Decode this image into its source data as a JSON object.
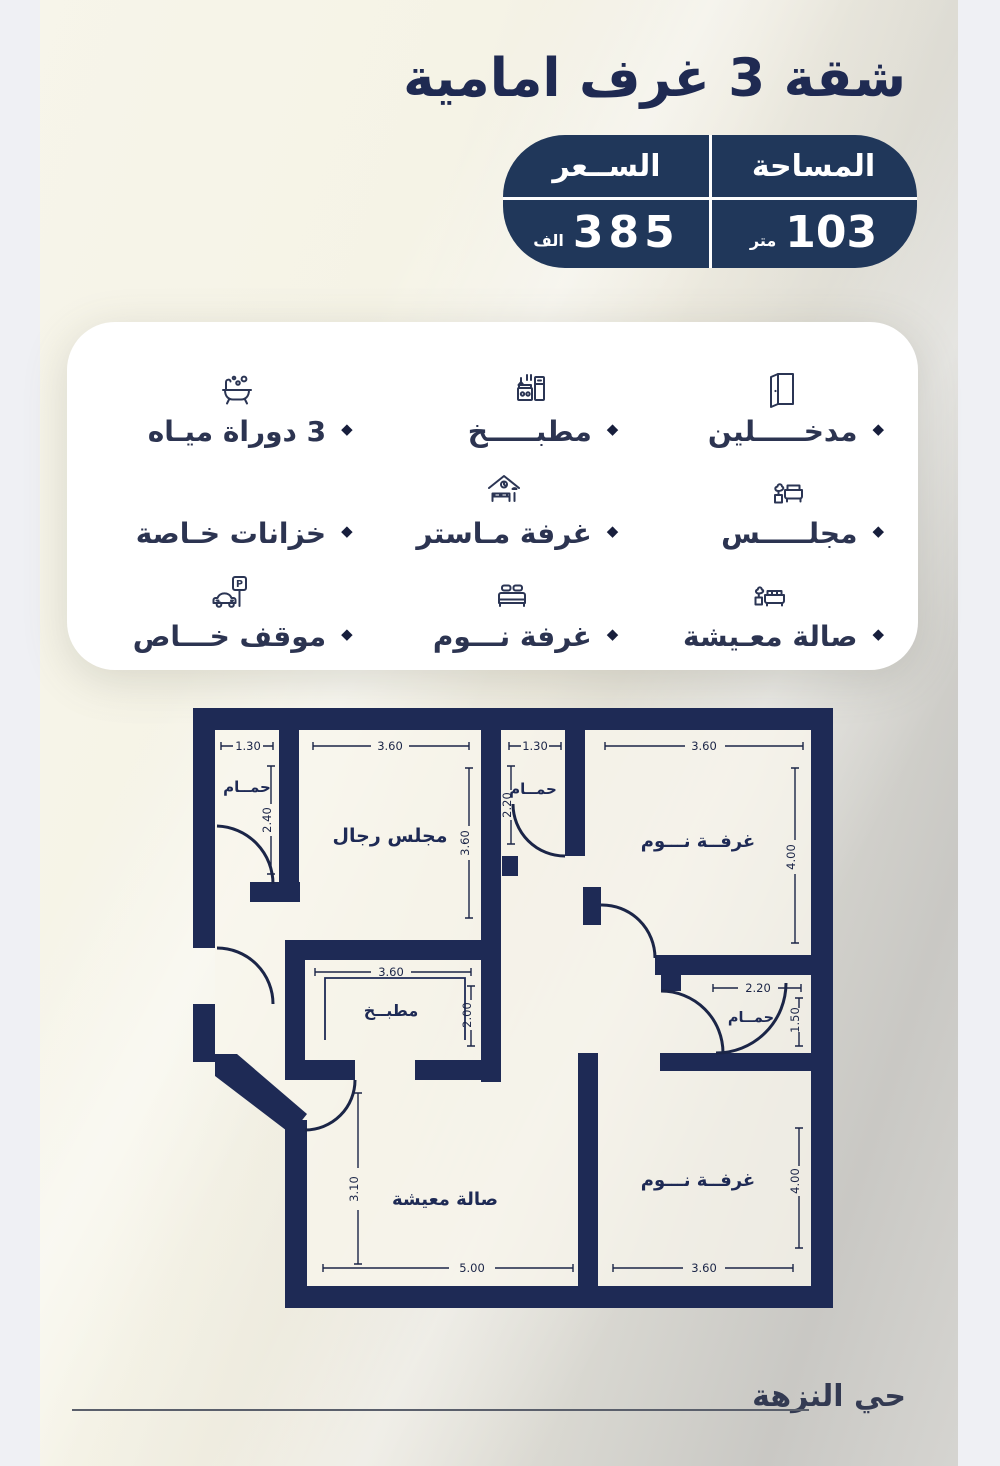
{
  "page": {
    "title": "شقة 3 غرف امامية"
  },
  "info_box": {
    "area": {
      "label": "المساحة",
      "value": "103",
      "unit": "متر"
    },
    "price": {
      "label": "الســعر",
      "value": "385",
      "unit": "الف"
    }
  },
  "features": {
    "bullet": "◆",
    "parking_letter": "P",
    "items": [
      {
        "label": "مدخـــــلين",
        "icon": "door-icon"
      },
      {
        "label": "مطبـــــخ",
        "icon": "kitchen-icon"
      },
      {
        "label": "3 دوراة ميـاه",
        "icon": "bathtub-icon"
      },
      {
        "label": "مجلـــــس",
        "icon": "majlis-sofa-icon"
      },
      {
        "label": "غرفة مـاستر",
        "icon": "master-bedroom-icon"
      },
      {
        "label": "خزانات خـاصة",
        "icon": "none"
      },
      {
        "label": "صالة معـيشة",
        "icon": "living-sofa-icon"
      },
      {
        "label": "غرفة نـــوم",
        "icon": "bed-icon"
      },
      {
        "label": "موقف خـــاص",
        "icon": "parking-icon"
      }
    ]
  },
  "floor_plan": {
    "rooms": {
      "bath_top_left": {
        "label": "حمــام",
        "width": "1.30",
        "height": "2.40"
      },
      "majlis": {
        "label": "مجلس رجال",
        "width": "3.60",
        "height": "3.60"
      },
      "bath_top_mid": {
        "label": "حمــام",
        "width": "1.30",
        "height": "2.20"
      },
      "bedroom_top": {
        "label": "غرفــة نـــوم",
        "width": "3.60",
        "height": "4.00"
      },
      "kitchen": {
        "label": "مطبــخ",
        "width": "3.60",
        "height": "2.00"
      },
      "bath_right": {
        "label": "حمــام",
        "width": "2.20",
        "height": "1.50"
      },
      "bedroom_bottom": {
        "label": "غرفــة نـــوم",
        "width": "3.60",
        "height": "4.00"
      },
      "living": {
        "label": "صالة معيشة",
        "width": "5.00",
        "height": "3.10"
      }
    }
  },
  "footer": {
    "district": "حي النزهة"
  },
  "colors": {
    "navy_box": "#20375a",
    "wall_navy": "#1e2a55",
    "text_navy": "#1f2a52"
  }
}
